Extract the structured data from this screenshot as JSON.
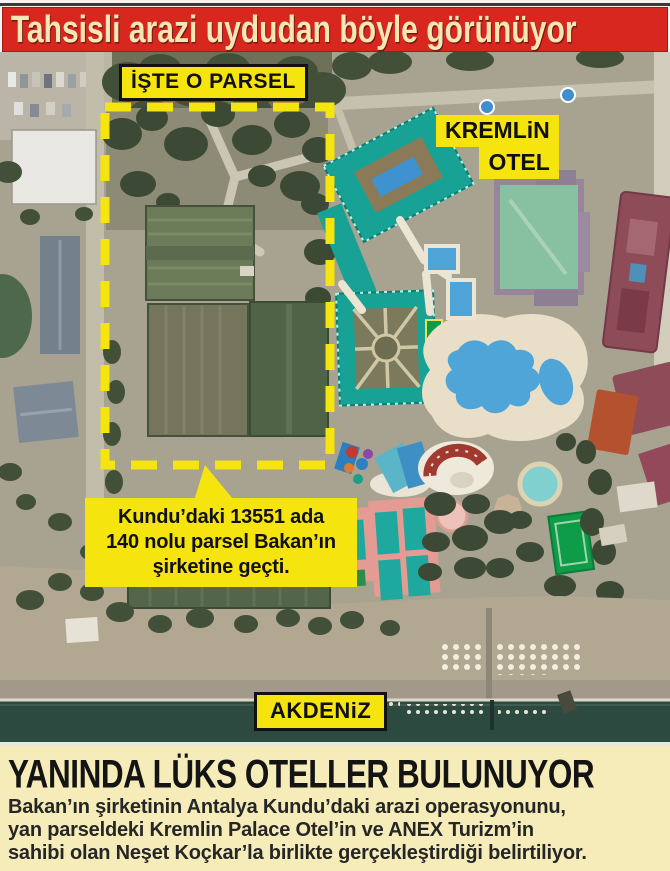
{
  "banner": {
    "title": "Tahsisli arazi uydudan böyle görünüyor",
    "bg_color": "#d7271f",
    "text_color": "#f6e8b4"
  },
  "map": {
    "labels": {
      "parcel_label": "İŞTE O PARSEL",
      "hotel_label_line1": "KREMLiN",
      "hotel_label_line2": "OTEL",
      "sea_label": "AKDENiZ",
      "partial_sign_text": "i"
    },
    "callout": {
      "lines": [
        "Kundu’daki 13551 ada",
        "140 nolu parsel Bakan’ın",
        "şirketine geçti."
      ]
    },
    "colors": {
      "highlight_yellow": "#f6e40e",
      "sea": "#2d4a40",
      "sand": "#b2a791",
      "ground": "#a8a291",
      "vegetation": "#42503a",
      "hotel_teal": "#17a295",
      "roof_green": "#87c1a1",
      "roof_maroon": "#8e4b58",
      "pool_blue": "#4fa5d8",
      "deck_cream": "#e9dfc8",
      "court_pink": "#e39b94",
      "court_teal": "#1fa89e",
      "court_green": "#0f9c49"
    }
  },
  "footer": {
    "headline": "YANINDA LÜKS OTELLER BULUNUYOR",
    "body_lines": [
      "Bakan’ın şirketinin Antalya Kundu’daki arazi operasyonunu,",
      "yan parseldeki Kremlin Palace Otel’in ve ANEX Turizm’in",
      "sahibi olan Neşet Koçkar’la birlikte gerçekleştirdiği belirtiliyor."
    ]
  }
}
